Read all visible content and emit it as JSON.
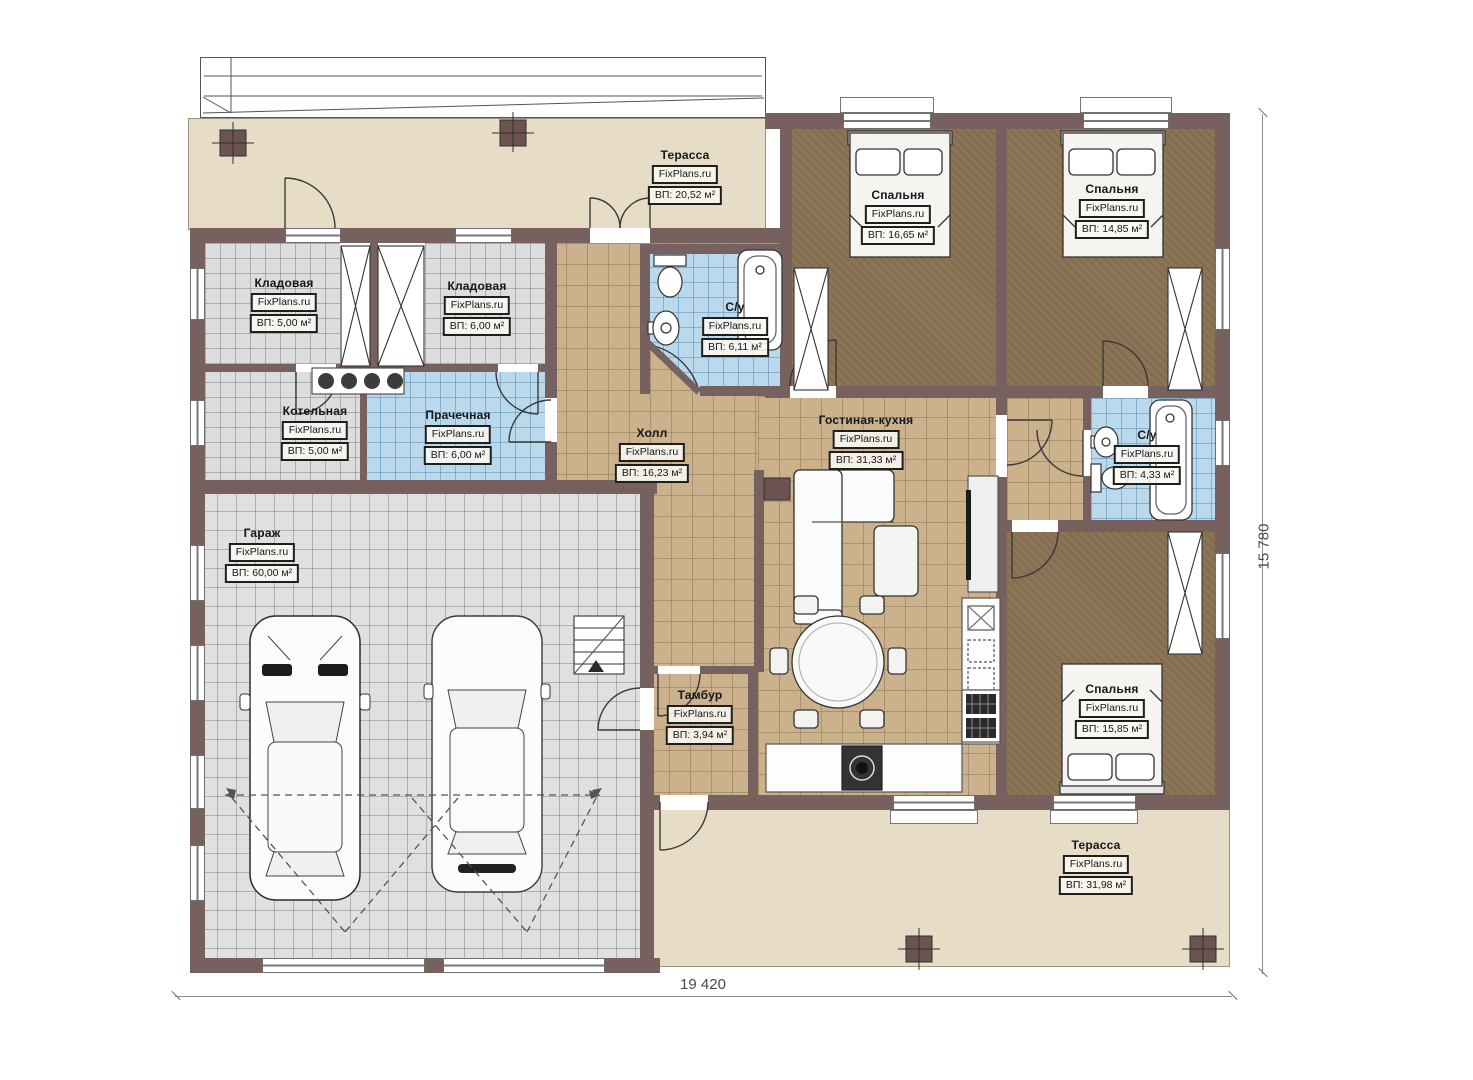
{
  "plan": {
    "brand": "FixPlans.ru",
    "dimension_width": "19 420",
    "dimension_height": "15 780",
    "rooms": [
      {
        "key": "terrace-top",
        "name": "Терасса",
        "brand": "FixPlans.ru",
        "area": "ВП: 20,52 м²"
      },
      {
        "key": "bedroom-1",
        "name": "Спальня",
        "brand": "FixPlans.ru",
        "area": "ВП: 16,65 м²"
      },
      {
        "key": "bedroom-2",
        "name": "Спальня",
        "brand": "FixPlans.ru",
        "area": "ВП: 14,85 м²"
      },
      {
        "key": "storage-1",
        "name": "Кладовая",
        "brand": "FixPlans.ru",
        "area": "ВП: 5,00 м²"
      },
      {
        "key": "storage-2",
        "name": "Кладовая",
        "brand": "FixPlans.ru",
        "area": "ВП: 6,00 м²"
      },
      {
        "key": "bathroom-1",
        "name": "С/у",
        "brand": "FixPlans.ru",
        "area": "ВП: 6,11 м²"
      },
      {
        "key": "boiler-room",
        "name": "Котельная",
        "brand": "FixPlans.ru",
        "area": "ВП: 5,00 м²"
      },
      {
        "key": "laundry",
        "name": "Прачечная",
        "brand": "FixPlans.ru",
        "area": "ВП: 6,00 м²"
      },
      {
        "key": "hall",
        "name": "Холл",
        "brand": "FixPlans.ru",
        "area": "ВП: 16,23 м²"
      },
      {
        "key": "living-kitchen",
        "name": "Гостиная-кухня",
        "brand": "FixPlans.ru",
        "area": "ВП: 31,33 м²"
      },
      {
        "key": "bathroom-2",
        "name": "С/у",
        "brand": "FixPlans.ru",
        "area": "ВП: 4,33 м²"
      },
      {
        "key": "garage",
        "name": "Гараж",
        "brand": "FixPlans.ru",
        "area": "ВП: 60,00 м²"
      },
      {
        "key": "vestibule",
        "name": "Тамбур",
        "brand": "FixPlans.ru",
        "area": "ВП: 3,94 м²"
      },
      {
        "key": "bedroom-3",
        "name": "Спальня",
        "brand": "FixPlans.ru",
        "area": "ВП: 15,85 м²"
      },
      {
        "key": "terrace-bottom",
        "name": "Терасса",
        "brand": "FixPlans.ru",
        "area": "ВП: 31,98 м²"
      }
    ],
    "colors": {
      "wall": "#76615f",
      "terrace_floor": "#e7ddc7",
      "bedroom_floor": "#8c7456",
      "tile_tan": "#cbb28d",
      "tile_blue": "#bad9ec",
      "tile_gray": "#dddddd",
      "garage_floor": "#e0e0e0"
    }
  }
}
